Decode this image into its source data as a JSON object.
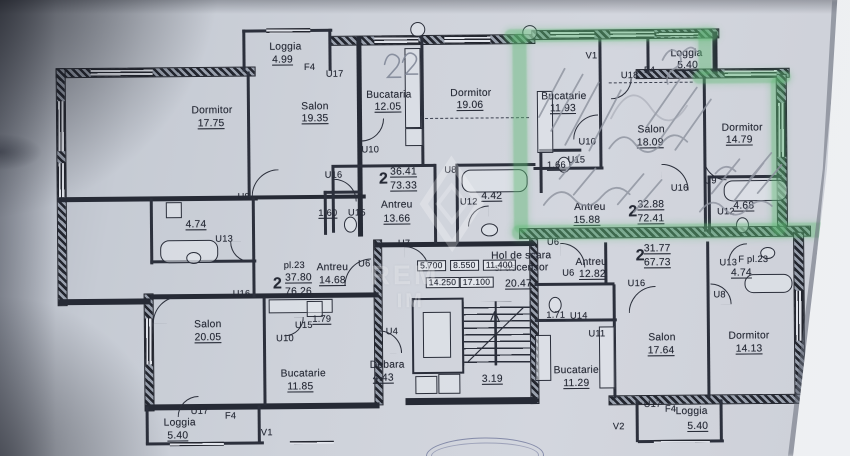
{
  "document": {
    "kind": "Scanned residential floor plan (photo of blueprint)",
    "language": "Romanian",
    "ink_color": "#262a35",
    "paper_color": "#ced2da",
    "highlight_color": "#5cb672",
    "highlighted_apartment": "top-right"
  },
  "watermark": {
    "text_top": "REM",
    "text_bottom": "IM"
  },
  "core": {
    "hall_label_line1": "Hol de scara",
    "hall_label_line2": "si ascensor",
    "hall_area": "20.47",
    "stair_area": "3.19",
    "debara_label": "Debara",
    "debara_area": "4.43",
    "elevation_marks": [
      "5.700",
      "8.550",
      "11.400",
      "14.250",
      "17.100"
    ]
  },
  "apartments": [
    {
      "id": "top-middle",
      "rooms": "2",
      "living_area": "36.41",
      "total_area": "73.33",
      "spaces": {
        "Salon": "19.35",
        "Dormitor": "19.06",
        "Bucataria": "12.05",
        "Antreu": "13.66",
        "Baie": "4.42",
        "WC": "1.60",
        "Loggia": "4.99"
      }
    },
    {
      "id": "left",
      "plan_no": "pl.23",
      "rooms": "2",
      "living_area": "37.80",
      "total_area": "76.26",
      "spaces": {
        "Dormitor": "17.75",
        "Salon": "20.05",
        "Bucatarie": "11.85",
        "Antreu": "14.68",
        "Baie": "4.74",
        "WC": "1.79",
        "Loggia": "5.40"
      }
    },
    {
      "id": "top-right-highlighted",
      "rooms": "2",
      "living_area": "32.88",
      "total_area": "72.41",
      "highlighted": true,
      "spaces": {
        "Salon": "18.09",
        "Dormitor": "14.79",
        "Bucatarie": "11.93",
        "Antreu": "15.88",
        "Baie": "4.68",
        "WC": "1.66",
        "Loggia": "5.40"
      }
    },
    {
      "id": "bottom-right",
      "rooms": "2",
      "living_area": "31.77",
      "total_area": "67.73",
      "bath_plan_no": "F pl.23",
      "spaces": {
        "Salon": "17.64",
        "Dormitor": "14.13",
        "Bucatarie": "11.29",
        "Antreu": "12.82",
        "Baie": "4.74",
        "WC": "1.71",
        "Loggia": "5.40"
      }
    }
  ],
  "labels": [
    {
      "n": "dormitor-tl-name",
      "t": "Dormitor"
    },
    {
      "n": "dormitor-tl-area",
      "t": "17.75"
    },
    {
      "n": "loggia-tl-name",
      "t": "Loggia"
    },
    {
      "n": "loggia-tl-area",
      "t": "4.99"
    },
    {
      "n": "door-f4-tl",
      "t": "F4"
    },
    {
      "n": "door-u17-tl",
      "t": "U17"
    },
    {
      "n": "salon-tl-name",
      "t": "Salon"
    },
    {
      "n": "salon-tl-area",
      "t": "19.35"
    },
    {
      "n": "bucataria-tm-name",
      "t": "Bucataria"
    },
    {
      "n": "bucataria-tm-area",
      "t": "12.05"
    },
    {
      "n": "dormitor-tm-name",
      "t": "Dormitor"
    },
    {
      "n": "dormitor-tm-area",
      "t": "19.06"
    },
    {
      "n": "door-u10-tl",
      "t": "U10"
    },
    {
      "n": "door-u16-tl",
      "t": "U16"
    },
    {
      "n": "door-u8-tl",
      "t": "U8"
    },
    {
      "n": "wc-tl-area",
      "t": "1.60"
    },
    {
      "n": "door-u15-tl",
      "t": "U15"
    },
    {
      "n": "apt-tm-rooms",
      "t": "2"
    },
    {
      "n": "apt-tm-living",
      "t": "36.41"
    },
    {
      "n": "apt-tm-total",
      "t": "73.33"
    },
    {
      "n": "antreu-tm-name",
      "t": "Antreu"
    },
    {
      "n": "antreu-tm-area",
      "t": "13.66"
    },
    {
      "n": "door-u8-tm",
      "t": "U8"
    },
    {
      "n": "door-u12-tm",
      "t": "U12"
    },
    {
      "n": "bath-tm-area",
      "t": "4.42"
    },
    {
      "n": "door-u7-core",
      "t": "U7"
    },
    {
      "n": "bath-left-area",
      "t": "4.74"
    },
    {
      "n": "door-u13-left",
      "t": "U13"
    },
    {
      "n": "apt-left-plan",
      "t": "pl.23"
    },
    {
      "n": "apt-left-rooms",
      "t": "2"
    },
    {
      "n": "apt-left-living",
      "t": "37.80"
    },
    {
      "n": "apt-left-total",
      "t": "76.26"
    },
    {
      "n": "antreu-left-name",
      "t": "Antreu"
    },
    {
      "n": "antreu-left-area",
      "t": "14.68"
    },
    {
      "n": "door-u6-left",
      "t": "U6"
    },
    {
      "n": "wc-left-area",
      "t": "1.79"
    },
    {
      "n": "door-u15-left",
      "t": "U15"
    },
    {
      "n": "door-u10-left",
      "t": "U10"
    },
    {
      "n": "salon-bl-name",
      "t": "Salon"
    },
    {
      "n": "salon-bl-area",
      "t": "20.05"
    },
    {
      "n": "door-u16-bl",
      "t": "U16"
    },
    {
      "n": "bucatarie-bl-name",
      "t": "Bucatarie"
    },
    {
      "n": "bucatarie-bl-area",
      "t": "11.85"
    },
    {
      "n": "door-u17-bl",
      "t": "U17"
    },
    {
      "n": "door-f4-bl",
      "t": "F4"
    },
    {
      "n": "loggia-bl-name",
      "t": "Loggia"
    },
    {
      "n": "loggia-bl-area",
      "t": "5.40"
    },
    {
      "n": "vent-v1-bl",
      "t": "V1"
    },
    {
      "n": "door-u4-core",
      "t": "U4"
    },
    {
      "n": "debara-name",
      "t": "Debara"
    },
    {
      "n": "debara-area",
      "t": "4.43"
    },
    {
      "n": "hall-label-1",
      "t": "Hol de scara"
    },
    {
      "n": "hall-label-2",
      "t": "si ascensor"
    },
    {
      "n": "hall-area",
      "t": "20.47"
    },
    {
      "n": "level-1",
      "t": "5.700"
    },
    {
      "n": "level-2",
      "t": "8.550"
    },
    {
      "n": "level-3",
      "t": "11.400"
    },
    {
      "n": "level-4",
      "t": "14.250"
    },
    {
      "n": "level-5",
      "t": "17.100"
    },
    {
      "n": "stair-area",
      "t": "3.19"
    },
    {
      "n": "door-u6-core",
      "t": "U6"
    },
    {
      "n": "bucatarie-g-name",
      "t": "Bucatarie"
    },
    {
      "n": "bucatarie-g-area",
      "t": "11.93"
    },
    {
      "n": "vent-v1-g",
      "t": "V1"
    },
    {
      "n": "door-u18-g",
      "t": "U18"
    },
    {
      "n": "door-f4-g",
      "t": "F4"
    },
    {
      "n": "loggia-g-name",
      "t": "Loggia"
    },
    {
      "n": "loggia-g-area",
      "t": "5.40"
    },
    {
      "n": "salon-g-name",
      "t": "Salon"
    },
    {
      "n": "salon-g-area",
      "t": "18.09"
    },
    {
      "n": "dormitor-g-name",
      "t": "Dormitor"
    },
    {
      "n": "dormitor-g-area",
      "t": "14.79"
    },
    {
      "n": "door-u10-g",
      "t": "U10"
    },
    {
      "n": "door-u15-g",
      "t": "U15"
    },
    {
      "n": "wc-g-area",
      "t": "1.66"
    },
    {
      "n": "antreu-g-name",
      "t": "Antreu"
    },
    {
      "n": "antreu-g-area",
      "t": "15.88"
    },
    {
      "n": "apt-g-rooms",
      "t": "2"
    },
    {
      "n": "apt-g-living",
      "t": "32.88"
    },
    {
      "n": "apt-g-total",
      "t": "72.41"
    },
    {
      "n": "door-u16-g",
      "t": "U16"
    },
    {
      "n": "door-u9-g",
      "t": "U9"
    },
    {
      "n": "door-u12-g",
      "t": "U12"
    },
    {
      "n": "bath-g-area",
      "t": "4.68"
    },
    {
      "n": "apt-br-rooms",
      "t": "2"
    },
    {
      "n": "apt-br-living",
      "t": "31.77"
    },
    {
      "n": "apt-br-total",
      "t": "67.73"
    },
    {
      "n": "antreu-br-name",
      "t": "Antreu"
    },
    {
      "n": "antreu-br-area",
      "t": "12.82"
    },
    {
      "n": "door-u6-br",
      "t": "U6"
    },
    {
      "n": "wc-br-area",
      "t": "1.71"
    },
    {
      "n": "door-u14-br",
      "t": "U14"
    },
    {
      "n": "door-u11-br",
      "t": "U11"
    },
    {
      "n": "door-u13-br",
      "t": "U13"
    },
    {
      "n": "bath-br-plan",
      "t": "F pl.23"
    },
    {
      "n": "bath-br-area",
      "t": "4.74"
    },
    {
      "n": "door-u8-br",
      "t": "U8"
    },
    {
      "n": "door-u16-br",
      "t": "U16"
    },
    {
      "n": "bucatarie-br-name",
      "t": "Bucatarie"
    },
    {
      "n": "bucatarie-br-area",
      "t": "11.29"
    },
    {
      "n": "salon-br-name",
      "t": "Salon"
    },
    {
      "n": "salon-br-area",
      "t": "17.64"
    },
    {
      "n": "dormitor-br-name",
      "t": "Dormitor"
    },
    {
      "n": "dormitor-br-area",
      "t": "14.13"
    },
    {
      "n": "door-u17-br",
      "t": "U17"
    },
    {
      "n": "door-f4-br",
      "t": "F4"
    },
    {
      "n": "loggia-br-name",
      "t": "Loggia"
    },
    {
      "n": "loggia-br-area",
      "t": "5.40"
    },
    {
      "n": "vent-v2-br",
      "t": "V2"
    }
  ]
}
